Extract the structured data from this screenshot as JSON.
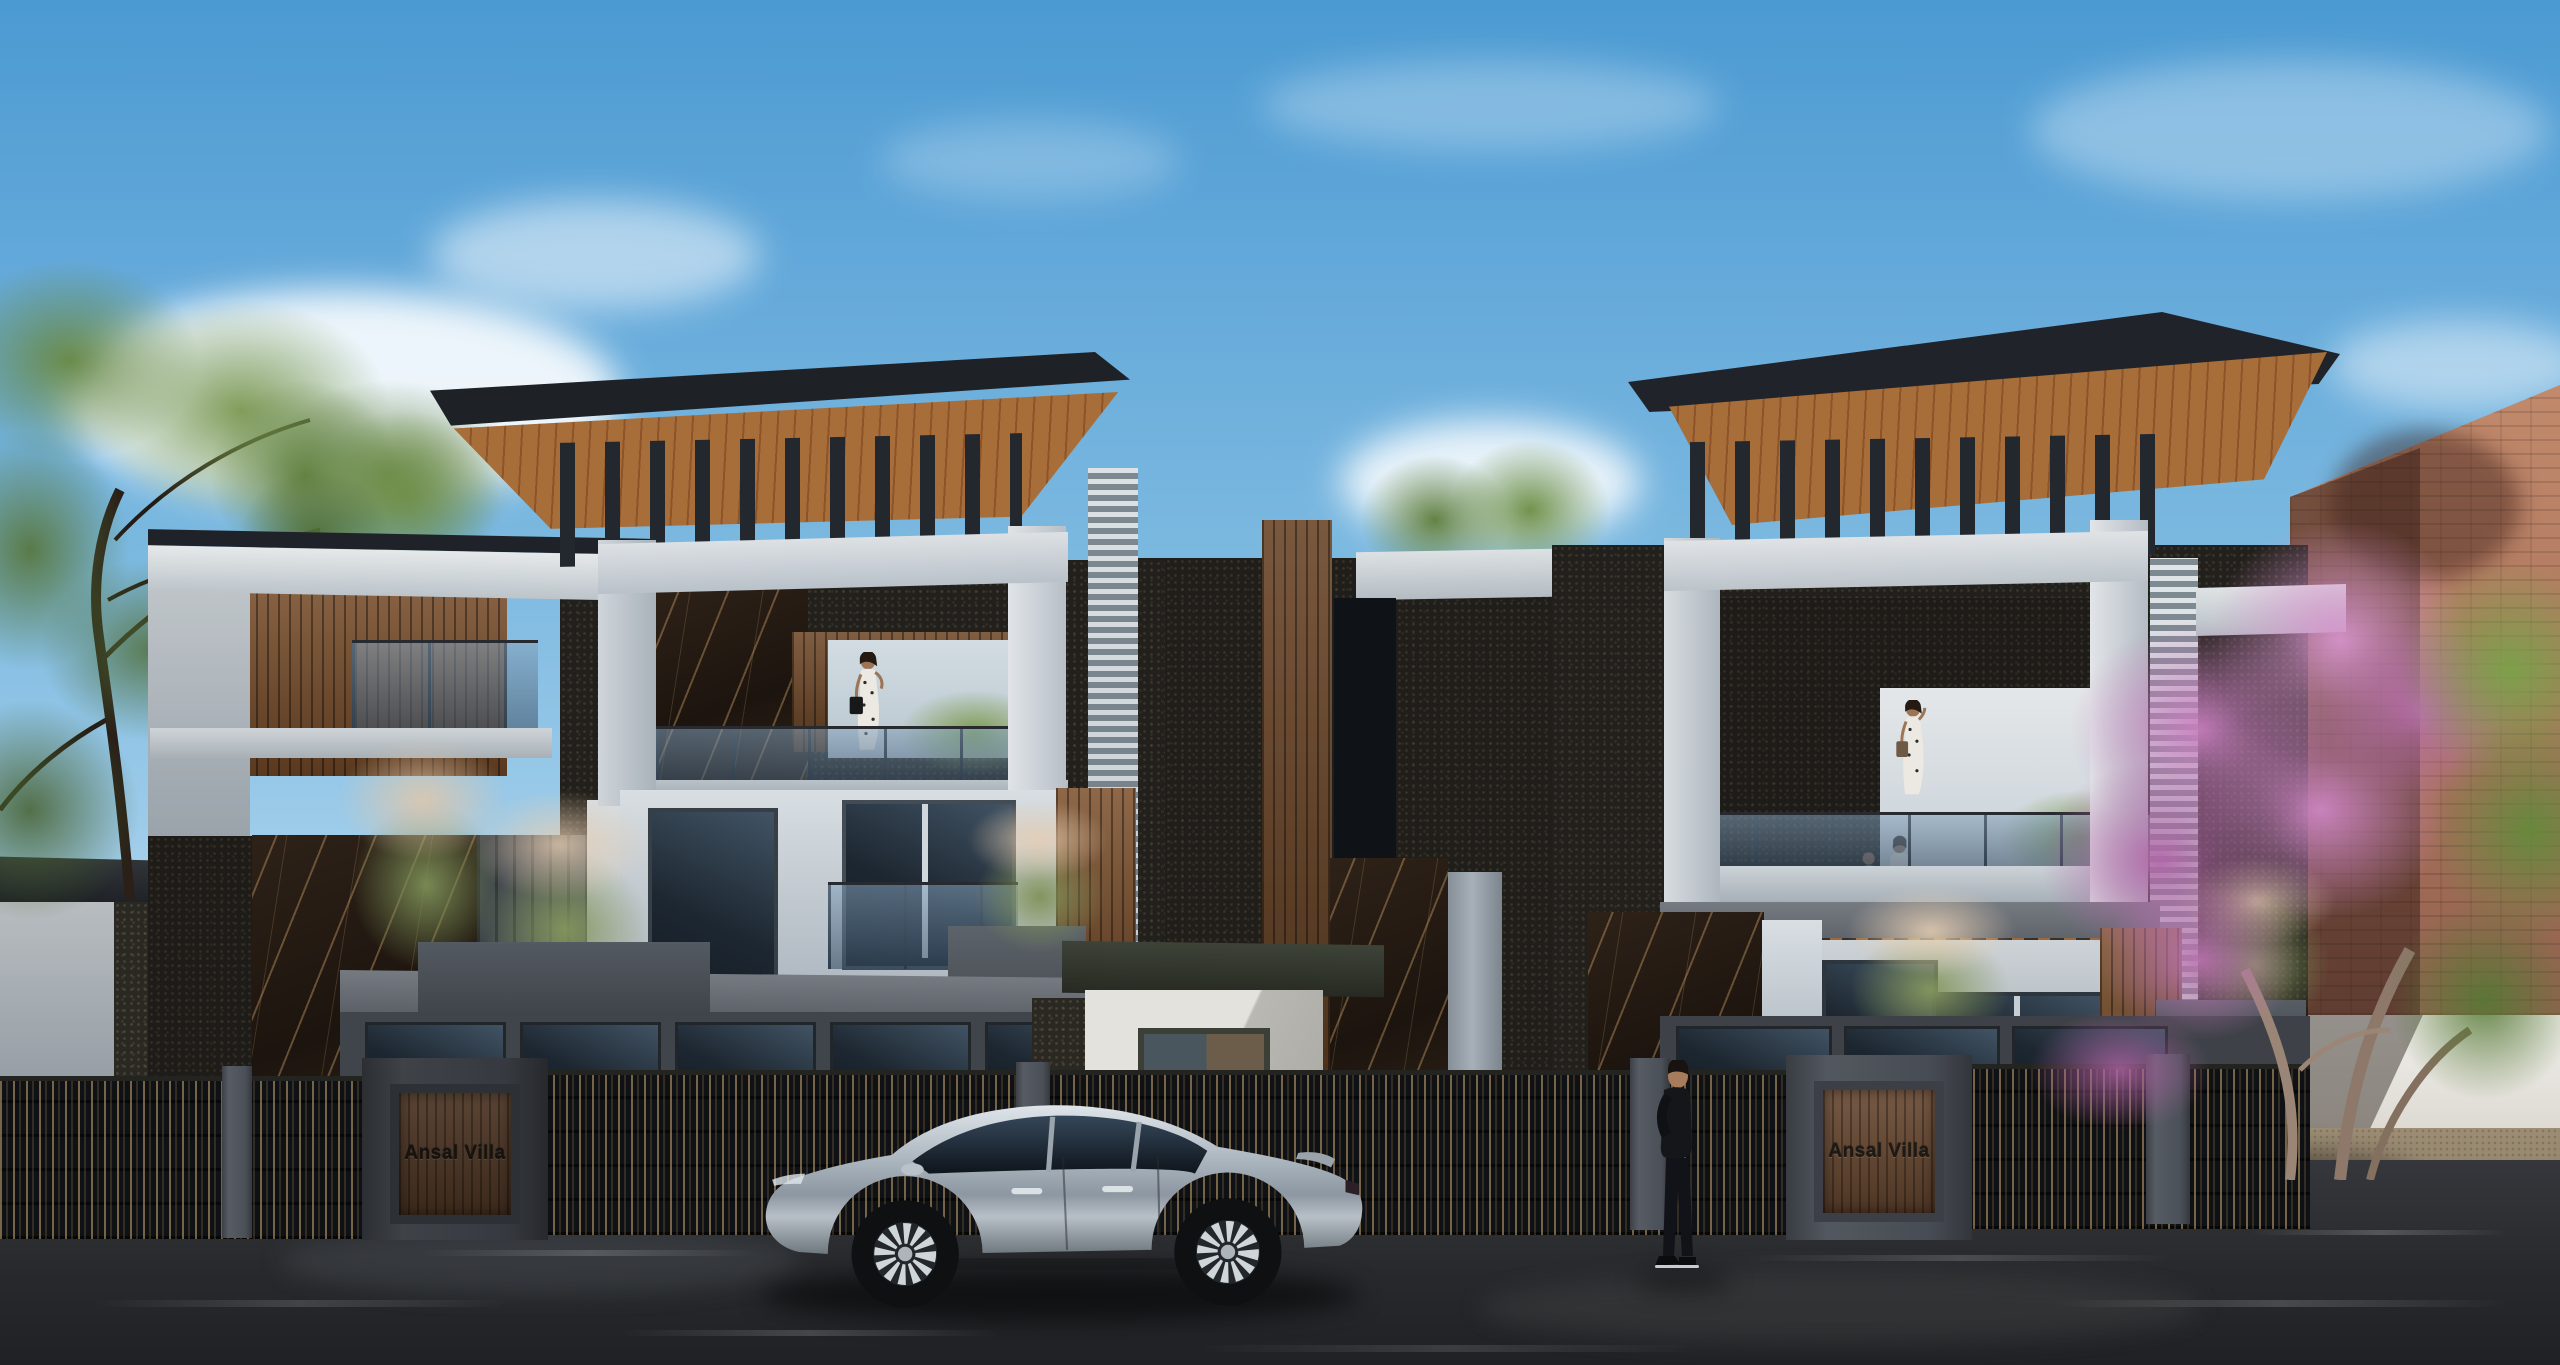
{
  "scene": {
    "type": "3d-architectural-exterior-render",
    "description": "Street-view daytime render of two modern three-storey villas with cantilevered wood-soffit roofs, dark vertical roof fins, white stone portal frames, black-gold marble and pebble-stone cladding, wood slat accents, glass balconies with grass planters; a dark metal picket fence with gate pillars runs along the street, a silver SUV is parked on the wet asphalt road, a man in black stands by the right gate, women stand on the balconies, and a pink flowering tree and terracotta brick building close the right side.",
    "time_of_day": "daytime",
    "weather": "clear sky with scattered white clouds"
  },
  "signs": {
    "left_gate": "Ansal Villa",
    "right_gate": "Ansal Villa"
  },
  "entities": {
    "vehicle": "silver electric SUV, side profile facing left",
    "pedestrian": "man in black shirt and trousers standing at the right gate, facing left",
    "balcony_left_villa": "woman in polka-dot dress with black handbag",
    "balcony_right_villa_top": "woman in polka-dot dress talking on phone",
    "balcony_right_villa_lower": "two residents standing behind the glass railing"
  },
  "palette": {
    "sky_top": "#4b9ad2",
    "sky_horizon": "#c9e4f2",
    "cloud": "#f6fafc",
    "roof_fascia": "#1f2329",
    "wood_soffit": "#a06a38",
    "wood_slat": "#8a5a34",
    "stone_white_lit": "#dfe3e6",
    "stone_white_shade": "#a9b2ba",
    "marble_dark": "#2b2018",
    "marble_vein_gold": "#c89a66",
    "pebble_wall": "#2a2823",
    "glass_dark": "#222c36",
    "glass_balustrade": "#5a7088",
    "foliage_green": "#6d8f49",
    "grass_plume": "#dcc3ab",
    "blossom_pink": "#c77fbe",
    "brick_wall": "#b98066",
    "fence_metal": "#141517",
    "gate_pillar": "#4e525a",
    "sign_wood": "#6b4a31",
    "asphalt": "#2b2d31",
    "sidewalk_sunlit": "#97886f",
    "car_silver": "#b9c1c9"
  }
}
